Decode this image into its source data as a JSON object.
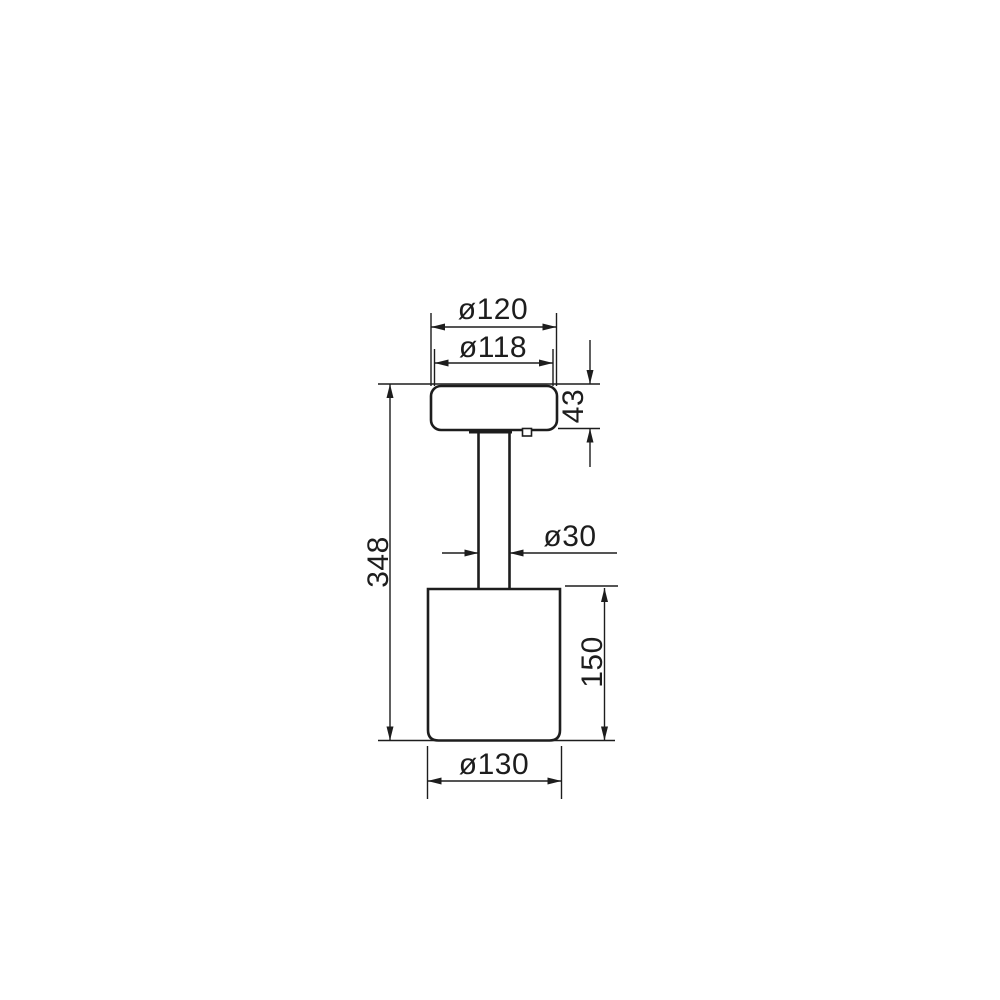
{
  "colors": {
    "line": "#1d1d1d",
    "background": "#ffffff"
  },
  "drawing": {
    "kind": "technical-dimension-drawing",
    "labels": {
      "head_outer_diameter": "ø120",
      "head_inner_diameter": "ø118",
      "head_height": "43",
      "total_height": "348",
      "stem_diameter": "ø30",
      "base_height": "150",
      "base_diameter": "ø130"
    }
  }
}
